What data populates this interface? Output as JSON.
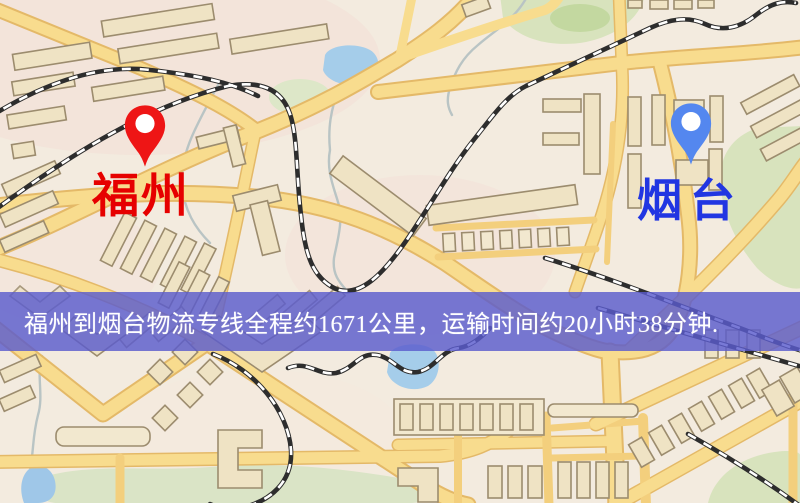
{
  "banner": {
    "text": "福州到烟台物流专线全程约1671公里，运输时间约20小时38分钟.",
    "bg_color": "#5a5ccd",
    "text_color": "#ffffff"
  },
  "markers": [
    {
      "city": "福州",
      "pin_color": "#ee1515",
      "pin_hole_color": "#ffffff",
      "label_color": "#e60000"
    },
    {
      "city": "烟台",
      "pin_color": "#5487ef",
      "pin_hole_color": "#ffffff",
      "label_color": "#2136e2"
    }
  ],
  "map_palette": {
    "background": "#f3ebdf",
    "pink_tint": "#f3ded6",
    "road_fill": "#f8dc8e",
    "road_casing": "#e4b968",
    "railway_dark": "#2d2d2d",
    "railway_light": "#ffffff",
    "water": "#a5cdea",
    "stream": "#b9c4c4",
    "park": "#d8e3bd",
    "park_dark": "#c3d8a0",
    "building_fill": "#efe3c4",
    "building_stroke": "#9c8c6e"
  }
}
